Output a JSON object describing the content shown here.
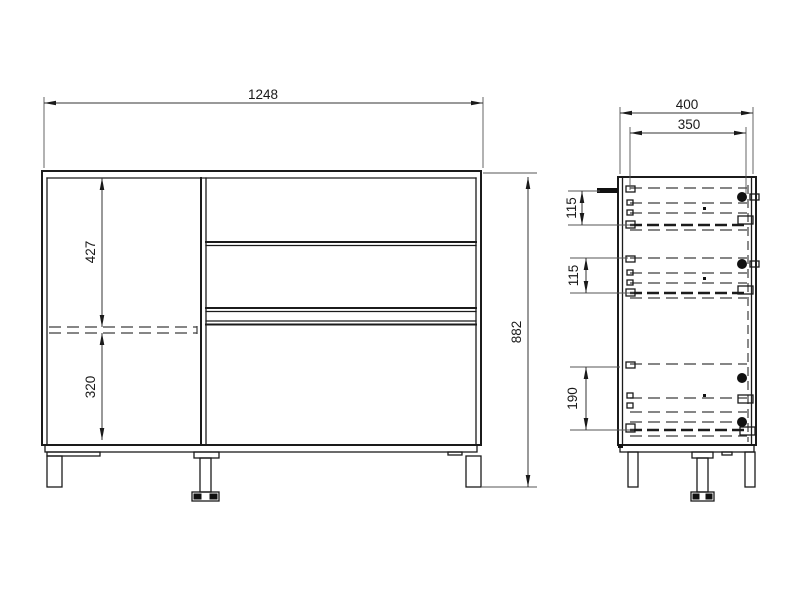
{
  "drawing_labels": {
    "front": {
      "width": "1248",
      "height": "882",
      "shelf_upper": "427",
      "shelf_lower": "320"
    },
    "side": {
      "depth": "400",
      "inner_depth": "350",
      "drawer_top": "115",
      "drawer_middle": "115",
      "drawer_bottom": "190"
    }
  }
}
